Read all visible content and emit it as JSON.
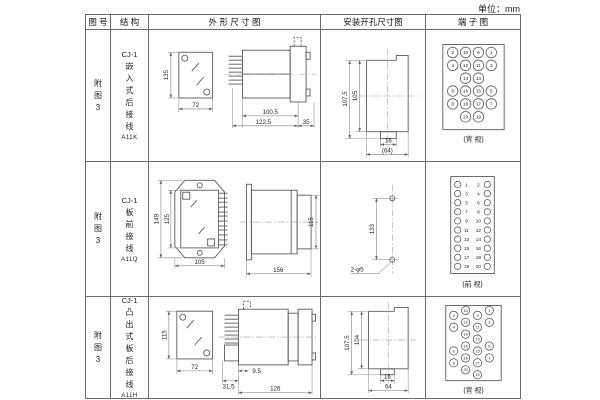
{
  "unit_label": "单位：mm",
  "headers": {
    "fig_no": "图 号",
    "structure": "结 构",
    "outline": "外 形 尺 寸 图",
    "install": "安装开孔尺寸图",
    "terminal": "端 子 图"
  },
  "rows": [
    {
      "fig_no": "附图3",
      "model": "CJ-1",
      "structure_desc": "嵌入式后接线",
      "code": "A11K",
      "outline": {
        "front_h": "135",
        "front_w": "72",
        "side_l1": "100.5",
        "side_l2": "122.5",
        "side_l3": "35"
      },
      "install": {
        "v_outer": "107.5",
        "v_inner": "105",
        "h_tab": "16",
        "h_overall": "(64)"
      },
      "terminal": {
        "view_label": "(背 视)",
        "pin_rows": [
          [
            2,
            10,
            9,
            1
          ],
          [
            4,
            12,
            11,
            3
          ],
          [
            null,
            14,
            13,
            null
          ],
          [
            6,
            16,
            15,
            5
          ],
          [
            8,
            18,
            17,
            7
          ],
          [
            null,
            20,
            19,
            null
          ]
        ]
      }
    },
    {
      "fig_no": "附图3",
      "model": "CJ-1",
      "structure_desc": "板前接线",
      "code": "A11Q",
      "outline": {
        "front_h": "149",
        "front_h2": "125",
        "front_w": "105",
        "side_l": "156",
        "side_h": "115"
      },
      "install": {
        "v": "133",
        "holes": "2-φ5"
      },
      "terminal": {
        "view_label": "(前 视)",
        "pin_rows": [
          [
            1,
            2
          ],
          [
            3,
            4
          ],
          [
            5,
            6
          ],
          [
            7,
            8
          ],
          [
            9,
            10
          ],
          [
            11,
            12
          ],
          [
            13,
            14
          ],
          [
            15,
            16
          ],
          [
            17,
            18
          ],
          [
            19,
            20
          ]
        ]
      }
    },
    {
      "fig_no": "附图3",
      "model": "CJ-1",
      "structure_desc": "凸出式板后接线",
      "code": "A11H",
      "outline": {
        "front_h": "115",
        "front_w": "72",
        "side_l1": "31.5",
        "side_l2": "9.5",
        "side_l3": "126"
      },
      "install": {
        "v_outer": "107.5",
        "v_inner": "104",
        "h_tab": "16",
        "h_overall": "64"
      },
      "terminal": {
        "view_label": "(背 视)",
        "pin_rows": [
          [
            2,
            10,
            9,
            1
          ],
          [
            4,
            12,
            11,
            3
          ],
          [
            null,
            14,
            13,
            null
          ],
          [
            6,
            16,
            15,
            5
          ],
          [
            8,
            18,
            17,
            7
          ],
          [
            null,
            20,
            19,
            null
          ]
        ]
      }
    }
  ]
}
